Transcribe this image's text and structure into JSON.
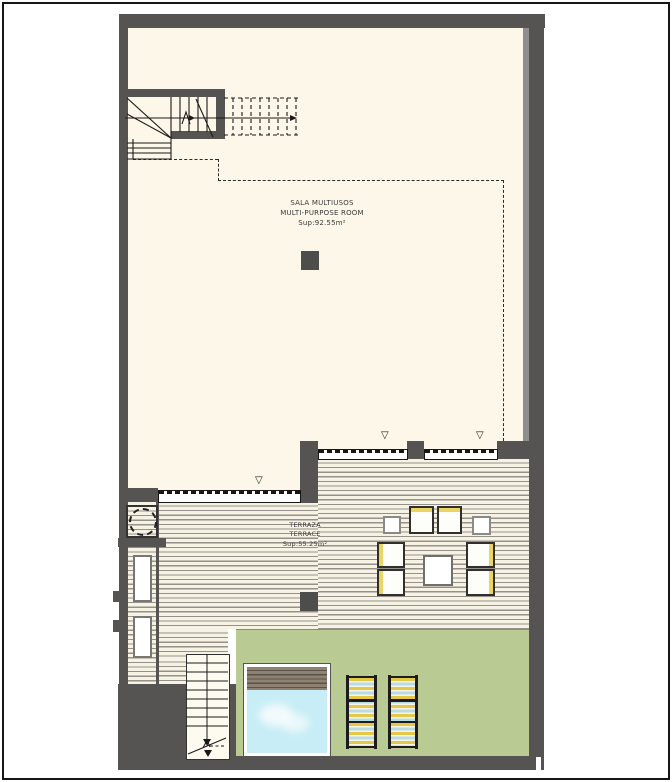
{
  "plan_title": "floor-plan",
  "rooms": {
    "multi_purpose_room": {
      "label_primary": "SALA MULTIUSOS",
      "label_secondary": "MULTI-PURPOSE ROOM",
      "area_label": "Sup:92.55m²"
    },
    "terrace": {
      "label_primary": "TERRAZA",
      "label_secondary": "TERRACE",
      "area_label": "Sup:55.25m²"
    }
  },
  "icons": {
    "door_marker": "▽"
  },
  "colors": {
    "wall": "#565452",
    "cream": "#fcf7e8",
    "deckBg": "#f6f2e4",
    "deckLine": "#95918a",
    "green": "#b9cb92",
    "water": "#c8edf6",
    "slat": "#8e8273",
    "slatLine": "#5a5349",
    "loungerYellow": "#e6c748",
    "loungerBlue": "#b9dbe3",
    "chairYellow": "#e9d464",
    "column": "#4d4d4b",
    "liner": "#8e8e8e"
  }
}
